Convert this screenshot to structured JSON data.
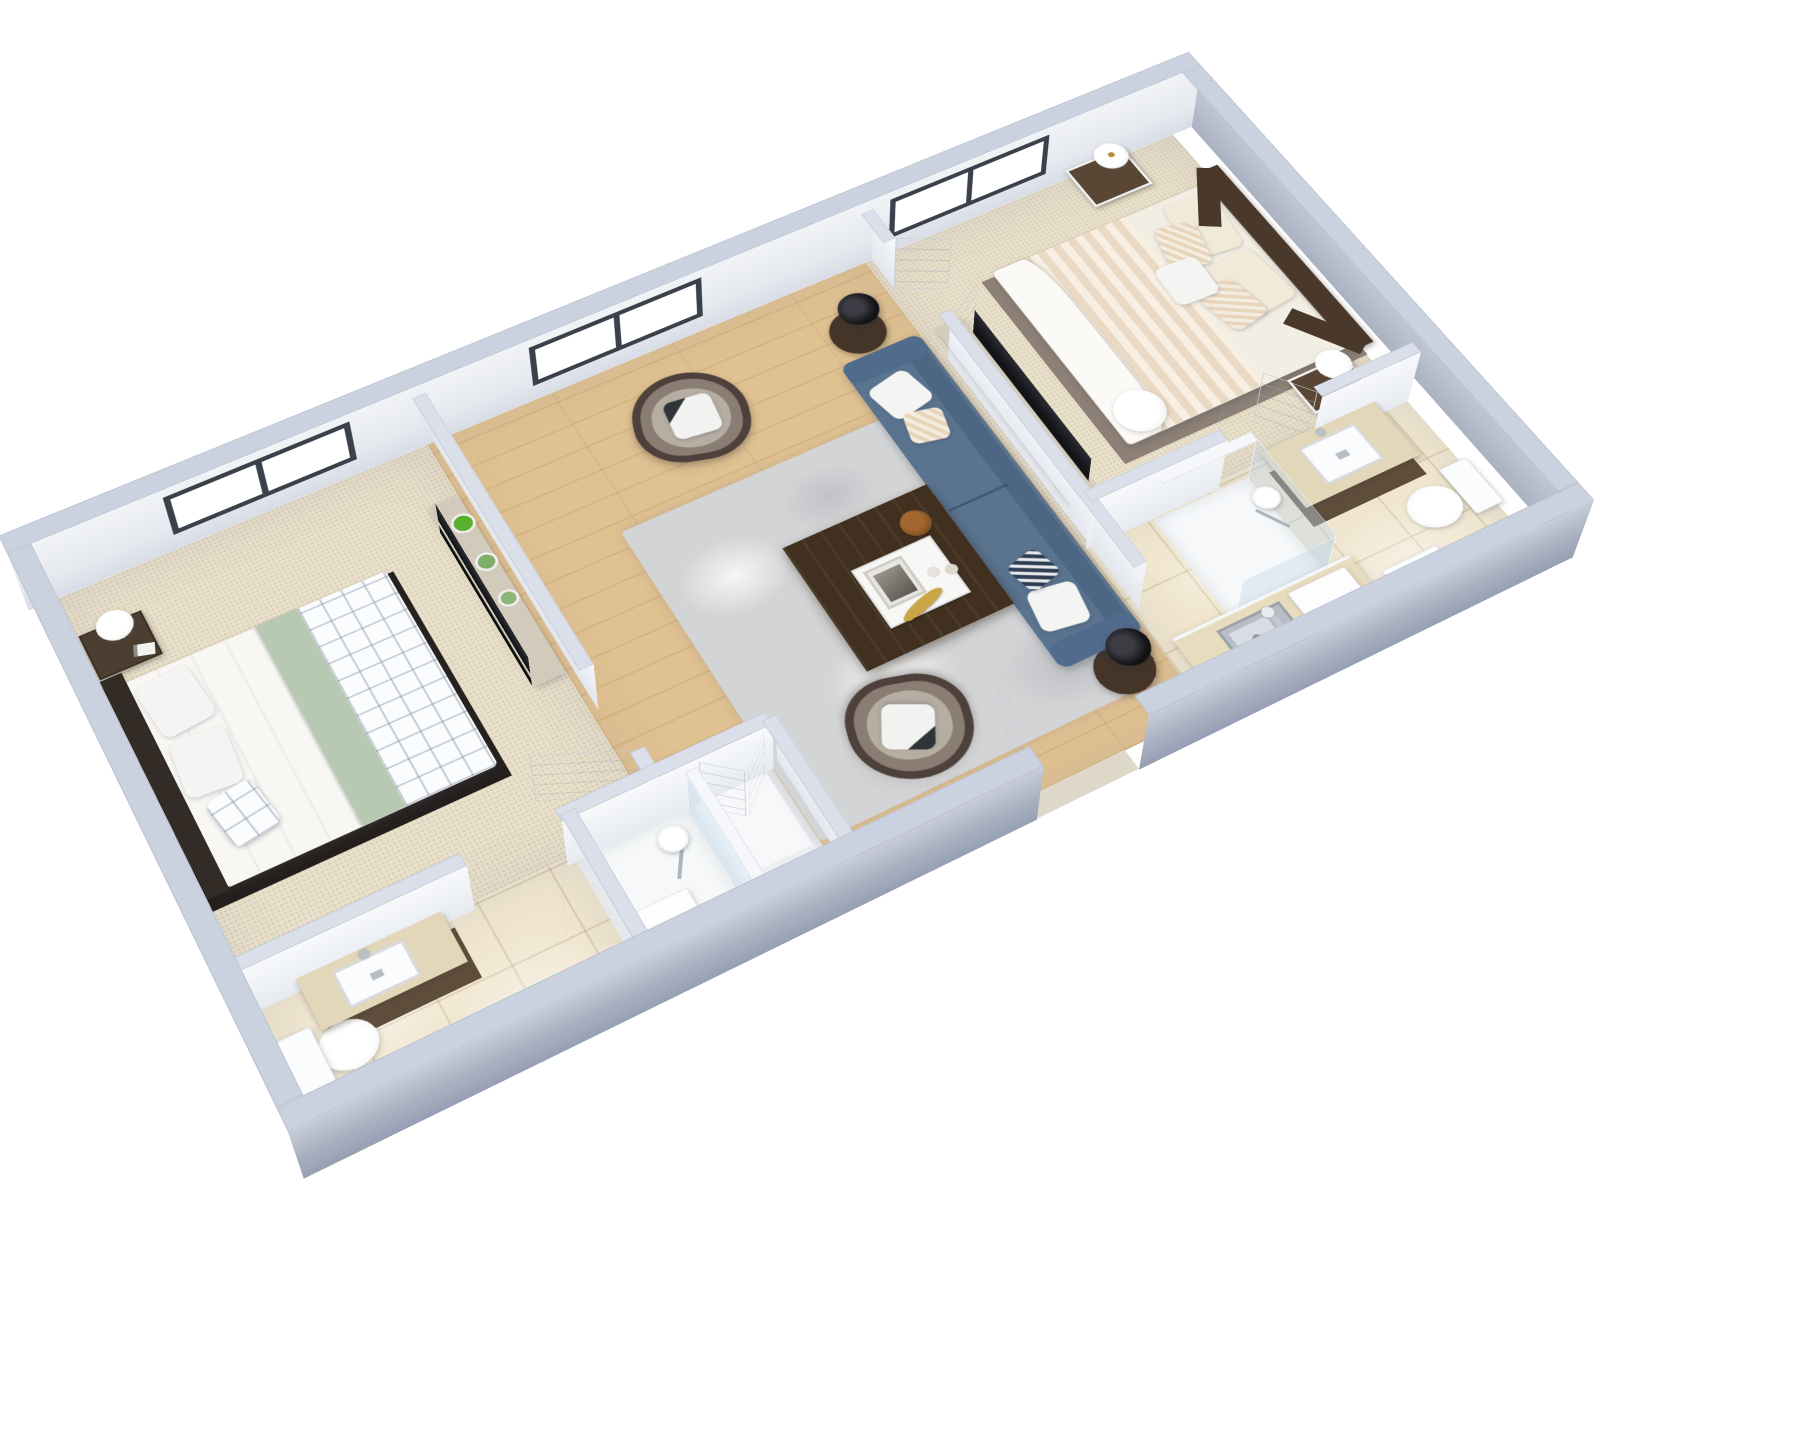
{
  "meta": {
    "title": "3D Floor Plan Rendering",
    "view": "axonometric 3D dollhouse view, rotated ~29 degrees, white background",
    "unit_type": "two-bedroom apartment"
  },
  "palette": {
    "background": "#ffffff",
    "wall_cap": "#cbd2df",
    "wall_face_interior": "#eef0f4",
    "wall_face_exterior_shadow": "#97a0b3",
    "window_frame": "#3a414b",
    "carpet": "#e9e0cb",
    "wood_floor": "#e0c191",
    "tile_floor": "#f0e6cf",
    "rug_gray": "#d3d4d6",
    "sofa_blue": "#5a7490",
    "armchair_taupe": "#b6aea3",
    "armchair_trim": "#4e413b",
    "coffee_table_wood": "#41301f",
    "dark_wood_furniture": "#5a4634",
    "sage_blanket": "#b7c9b3",
    "linen_cream": "#f3eee4",
    "tv_black": "#0b0c0e",
    "plant_green": "#58b02e",
    "fixture_white": "#ffffff"
  },
  "rooms": [
    {
      "id": "bedroom-2",
      "name": "Bedroom 2",
      "floor": "carpet",
      "furniture": [
        "double bed with sage green blanket and plaid duvet",
        "dark wood headboard",
        "dark wood nightstand with white lamp and book",
        "tv console with three potted plants",
        "flat screen tv"
      ]
    },
    {
      "id": "bathroom-2",
      "name": "Bathroom 2",
      "floor": "tile",
      "furniture": [
        "wood vanity with white sink",
        "toilet"
      ]
    },
    {
      "id": "hall-shower-closet",
      "name": "Hall shower room and closet",
      "floor": "white",
      "furniture": [
        "walk-in shower with round rain shower head",
        "white bench cabinet",
        "double-door closet"
      ]
    },
    {
      "id": "living-room",
      "name": "Living Room",
      "floor": "wood",
      "furniture": [
        "blue three-seat sofa with white and striped pillows",
        "two taupe barrel armchairs with dark trim",
        "dark walnut coffee table with white tray, gold banana and bowl",
        "gray shag area rug",
        "two round dark side tables",
        "two black drum table lamps"
      ]
    },
    {
      "id": "master-bedroom",
      "name": "Master Bedroom",
      "floor": "carpet",
      "furniture": [
        "king bed with striped cream duvet and pillow stack",
        "angled dark wood headboard",
        "two dark wood nightstands with gold-stem white lamps",
        "tv console",
        "flat screen tv"
      ]
    },
    {
      "id": "master-bath-kitchenette",
      "name": "Master Bathroom and Kitchenette",
      "floor": "tile",
      "furniture": [
        "kitchen counter with stainless steel sink",
        "white microwave",
        "walk-in shower with glass panel and rain head",
        "wood vanity with white sink",
        "toilet"
      ]
    }
  ],
  "openings": {
    "windows": [
      {
        "wall": "north",
        "room": "bedroom-2",
        "panes": 2
      },
      {
        "wall": "north",
        "room": "living-room",
        "panes": 2
      },
      {
        "wall": "north",
        "room": "master-bedroom",
        "panes": 2
      }
    ],
    "doors": [
      {
        "from": "outside",
        "to": "living-room",
        "type": "entry single, open"
      },
      {
        "from": "bedroom-2",
        "to": "living-room",
        "type": "single, open"
      },
      {
        "from": "bedroom-2",
        "to": "bathroom-2",
        "type": "single, open"
      },
      {
        "from": "living-room",
        "to": "master-bedroom",
        "type": "double, open"
      },
      {
        "from": "master-bedroom",
        "to": "master-bath-kitchenette",
        "type": "double, open"
      },
      {
        "from": "hall",
        "to": "closet",
        "type": "double, open"
      }
    ]
  }
}
